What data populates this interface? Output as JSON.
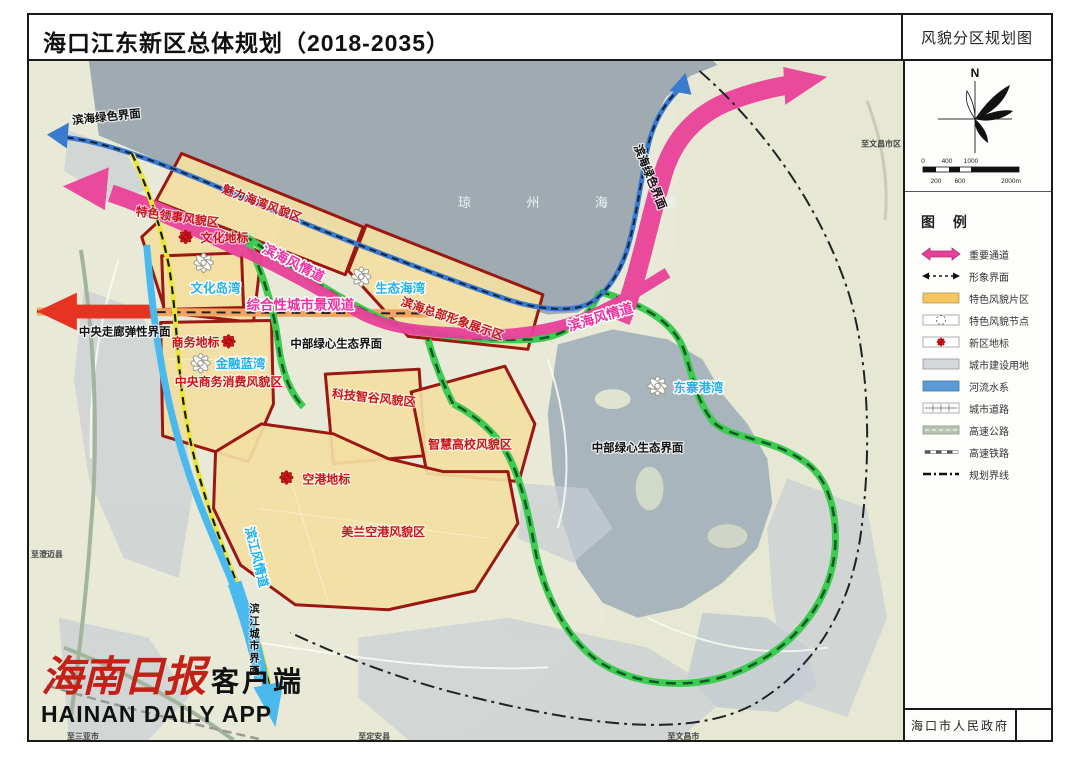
{
  "header": {
    "title": "海口江东新区总体规划（2018-2035）",
    "map_name": "风貌分区规划图"
  },
  "sidebar": {
    "compass_label": "N",
    "scale": {
      "ticks_top": [
        "0",
        "400",
        "1000"
      ],
      "ticks_bottom": [
        "200",
        "600",
        "2000m"
      ]
    },
    "legend": {
      "title": "图 例",
      "items": [
        {
          "symbol": "pink-double-arrow",
          "label": "重要通道",
          "color": "#e8409a"
        },
        {
          "symbol": "black-dashed-arrow",
          "label": "形象界面",
          "color": "#111111"
        },
        {
          "symbol": "yellow-area",
          "label": "特色风貌片区",
          "color": "#f6c55e"
        },
        {
          "symbol": "dashed-circle-node",
          "label": "特色风貌节点",
          "color": "#ffffff"
        },
        {
          "symbol": "red-flower-landmark",
          "label": "新区地标",
          "color": "#d61518"
        },
        {
          "symbol": "gray-area",
          "label": "城市建设用地",
          "color": "#d3d8db"
        },
        {
          "symbol": "blue-area",
          "label": "河流水系",
          "color": "#5b9bd5"
        },
        {
          "symbol": "city-road",
          "label": "城市道路",
          "color": "#888888"
        },
        {
          "symbol": "highway",
          "label": "高速公路",
          "color": "#b7c4b2"
        },
        {
          "symbol": "high-speed-rail",
          "label": "高速铁路",
          "color": "#555555"
        },
        {
          "symbol": "planning-boundary",
          "label": "规划界线",
          "color": "#111111"
        }
      ]
    },
    "footer": "海口市人民政府"
  },
  "map": {
    "labels": {
      "sea": "琼 州 海 峡",
      "coast_green_left": "滨海绿色界面",
      "coast_green_right": "滨海绿色界面",
      "charm_bay": "魅力海湾风貌区",
      "consulate": "特色领事风貌区",
      "culture_landmark": "文化地标",
      "culture_bay": "文化岛湾",
      "seaside_road_left": "滨海风情道",
      "seaside_road_right": "滨海风情道",
      "eco_bay": "生态海湾",
      "hq_zone": "滨海总部形象展示区",
      "comp_road": "综合性城市景观道",
      "central_corridor": "中央走廊弹性界面",
      "biz_landmark": "商务地标",
      "finance_bay": "金融蓝湾",
      "cbd_zone": "中央商务消费风貌区",
      "green_core_left": "中部绿心生态界面",
      "green_core_right": "中部绿心生态界面",
      "tech_zone": "科技智谷风貌区",
      "edu_zone": "智慧高校风貌区",
      "airport_landmark": "空港地标",
      "airport_zone": "美兰空港风貌区",
      "dongzhai_bay": "东寨港湾",
      "riverside_road": "滨江风情道",
      "riverside_interface": "滨江城市界面",
      "to_chengmai": "至澄迈县",
      "to_sanya": "至三亚市",
      "to_dingan": "至定安县",
      "to_wenchang": "至文昌市",
      "to_wenchang_city": "至文昌市区"
    },
    "colors": {
      "zone_fill": "#f3dfa2",
      "zone_border": "#9b1712",
      "corridor_green": "#3ecb52",
      "corridor_pink": "#e8409a",
      "sea": "#9fabb1",
      "river": "#49b9ee",
      "interface_blue": "#3a7bd0",
      "interface_yellow": "#e9e63b",
      "orange_band": "#f2a55e",
      "red_arrow": "#e63322"
    }
  },
  "logo": {
    "cn": "海南日报",
    "client": "客户端",
    "en": "HAINAN DAILY APP"
  }
}
